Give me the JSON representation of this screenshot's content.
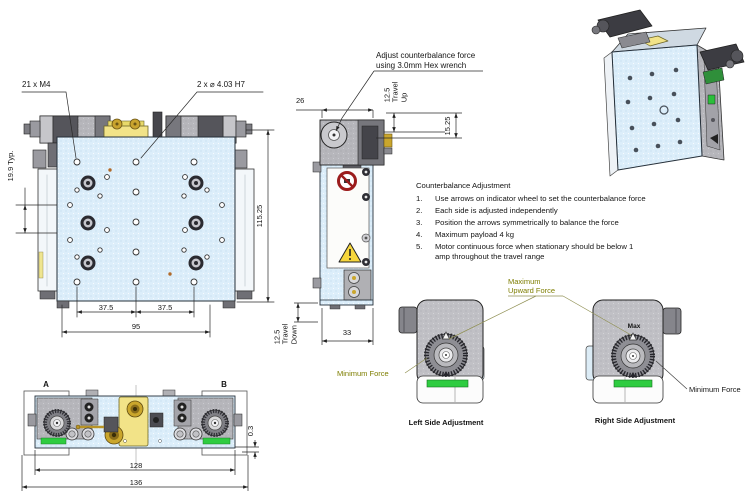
{
  "front": {
    "callout_m4": "21 x M4",
    "callout_h7": "2 x ⌀ 4.03 H7",
    "dim_typ": "19.9 Typ.",
    "dim_height": "115.25",
    "dim_span_left": "37.5",
    "dim_span_right": "37.5",
    "dim_width": "95"
  },
  "side": {
    "callout_hex": "Adjust counterbalance force\nusing 3.0mm Hex wrench",
    "dim_top_width": "26",
    "travel_up": "12.5\nTravel\nUp",
    "dim_travel_ref": "15.25",
    "dim_bottom_width": "33",
    "travel_down": "12.5\nTravel\nDown"
  },
  "bottom": {
    "marker_a": "A",
    "marker_b": "B",
    "dim_offset": "0.3",
    "dim_inner": "128",
    "dim_outer": "136"
  },
  "notes": {
    "title": "Counterbalance Adjustment",
    "items": [
      {
        "n": "1.",
        "text": "Use arrows on indicator wheel to set the counterbalance force"
      },
      {
        "n": "2.",
        "text": "Each side is adjusted independently"
      },
      {
        "n": "3.",
        "text": "Position the arrows symmetrically to balance the force"
      },
      {
        "n": "4.",
        "text": "Maximum payload 4 kg"
      },
      {
        "n": "5.",
        "text": "Motor continuous force when stationary should be below 1\namp throughout the travel range"
      }
    ]
  },
  "details": {
    "label_max_upward": "Maximum\nUpward Force",
    "label_min_left": "Minimum Force",
    "label_min_right": "Minimum Force",
    "label_max": "Max",
    "caption_left": "Left Side Adjustment",
    "caption_right": "Right Side Adjustment"
  },
  "colors": {
    "plate_blue": "#dceefa",
    "machine_gray": "#b6b6bb",
    "accent_yellow": "#f2e388",
    "indicator_green": "#2ecc40",
    "label_olive": "#7e7e00",
    "warning_red": "#9b1c1c"
  }
}
